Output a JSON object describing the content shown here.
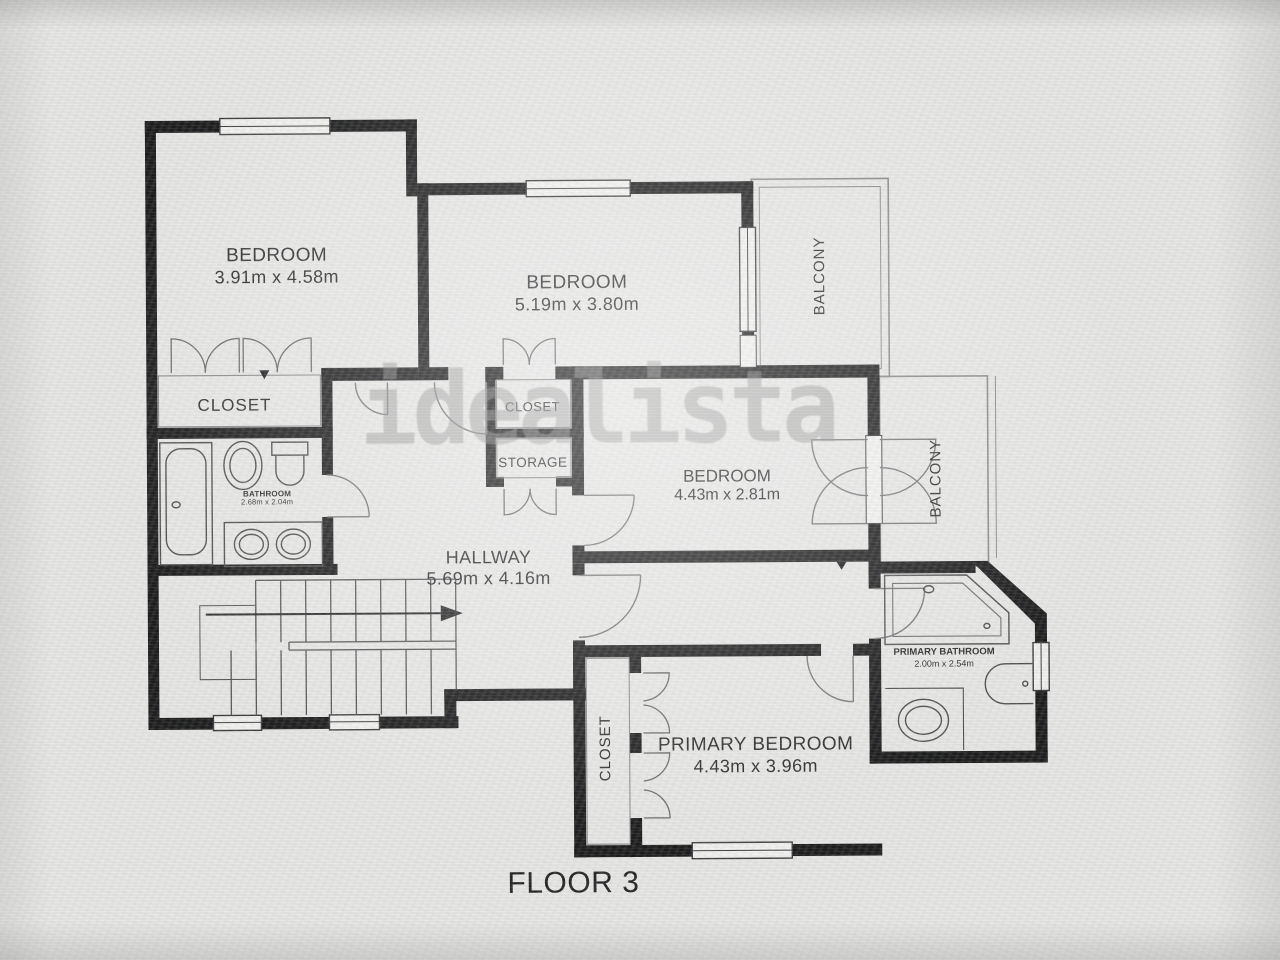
{
  "floor_label": "FLOOR 3",
  "watermark": "idealista",
  "colors": {
    "wall": "#1d1d1d",
    "line": "#5f5f5f",
    "paper": "#e8e7e5",
    "text": "#2d2d2d"
  },
  "rooms": {
    "bedroom1": {
      "name": "BEDROOM",
      "dims": "3.91m x 4.58m"
    },
    "bedroom2": {
      "name": "BEDROOM",
      "dims": "5.19m x 3.80m"
    },
    "bedroom3": {
      "name": "BEDROOM",
      "dims": "4.43m x 2.81m"
    },
    "primary_bedroom": {
      "name": "PRIMARY BEDROOM",
      "dims": "4.43m x 3.96m"
    },
    "hallway": {
      "name": "HALLWAY",
      "dims": "5.69m x 4.16m"
    },
    "bathroom": {
      "name": "BATHROOM",
      "dims": "2.68m x 2.04m"
    },
    "primary_bathroom": {
      "name": "PRIMARY BATHROOM",
      "dims": "2.00m x 2.54m"
    },
    "closet_main": {
      "name": "CLOSET"
    },
    "closet_hall": {
      "name": "CLOSET"
    },
    "storage": {
      "name": "STORAGE"
    },
    "closet_primary": {
      "name": "CLOSET"
    },
    "balcony_top": {
      "name": "BALCONY"
    },
    "balcony_right": {
      "name": "BALCONY"
    }
  }
}
